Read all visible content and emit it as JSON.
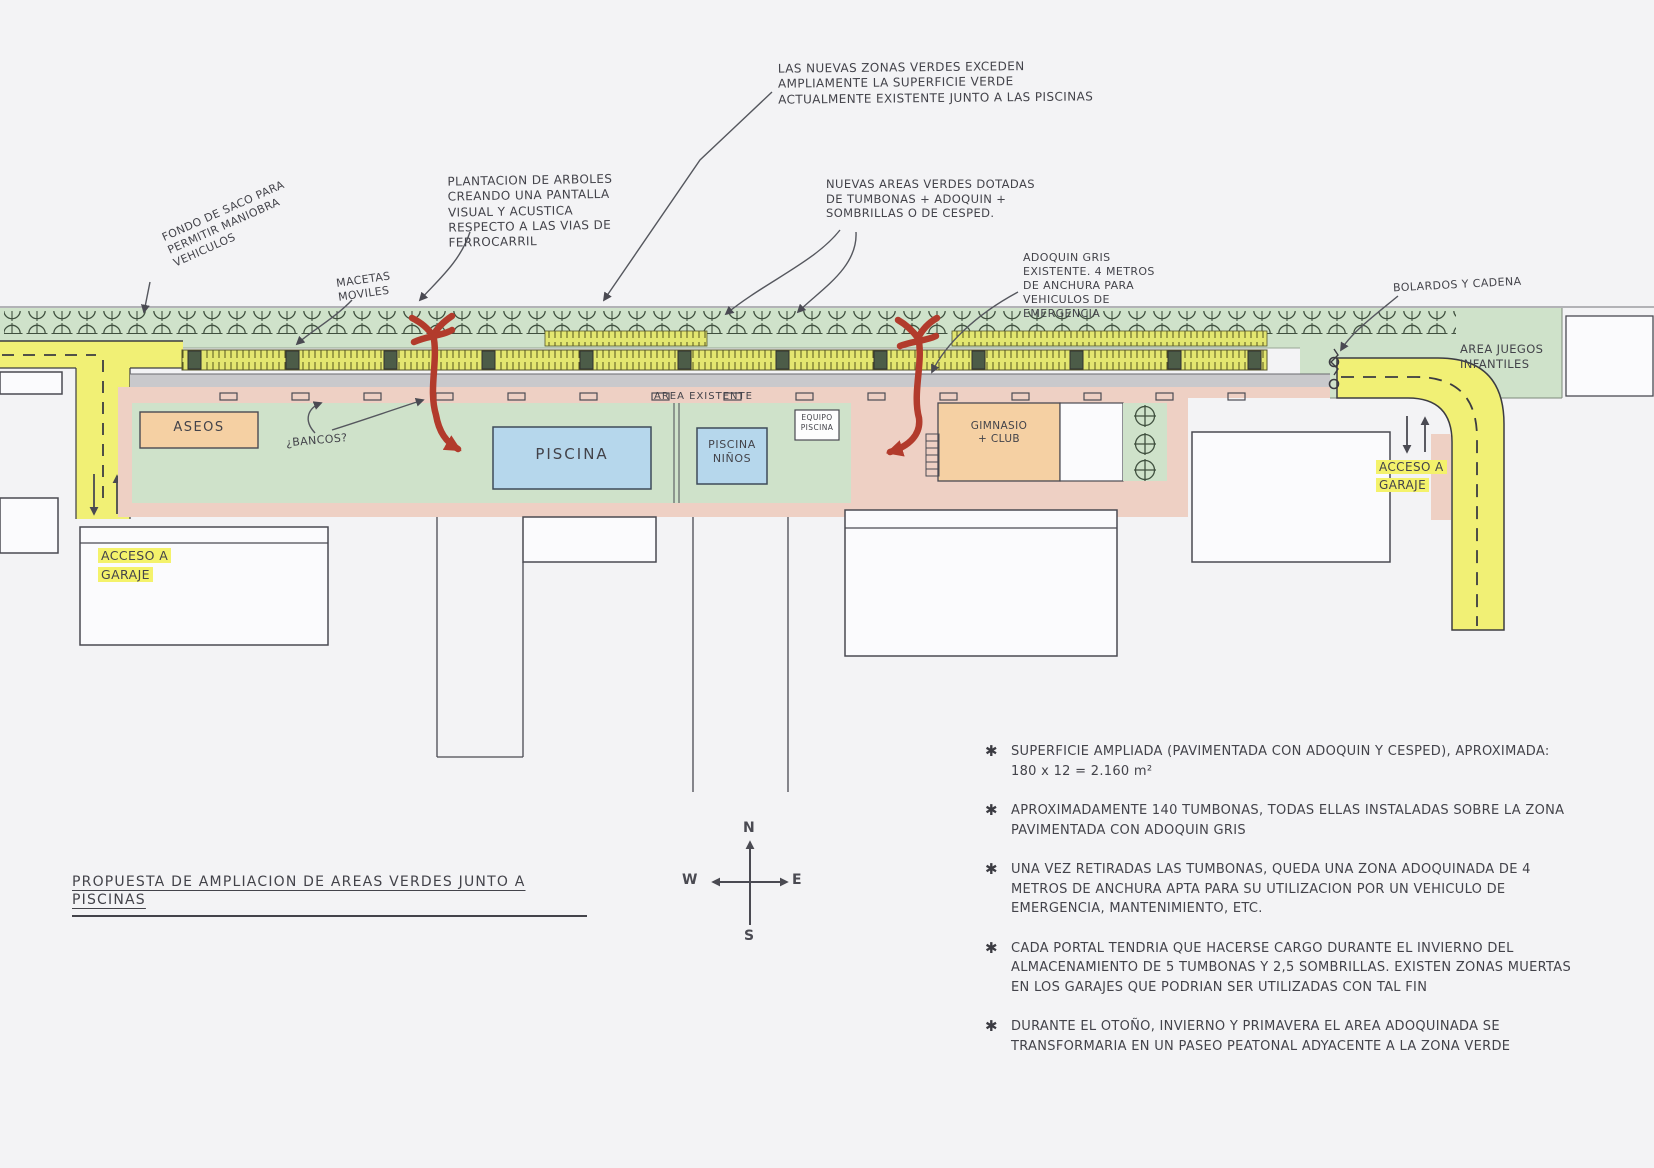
{
  "title": "PROPUESTA DE AMPLIACION DE AREAS VERDES JUNTO A PISCINAS",
  "note_bullet": "✱",
  "annotations": {
    "new_green_zones": "LAS NUEVAS ZONAS VERDES EXCEDEN AMPLIAMENTE LA SUPERFICIE VERDE ACTUALMENTE EXISTENTE JUNTO A LAS PISCINAS",
    "tree_planting": "PLANTACION DE ARBOLES CREANDO UNA PANTALLA VISUAL Y ACUSTICA RESPECTO A LAS VIAS DE FERROCARRIL",
    "new_green_areas": "NUEVAS AREAS VERDES DOTADAS DE TUMBONAS + ADOQUIN + SOMBRILLAS O DE CESPED.",
    "gray_paving": "ADOQUIN GRIS EXISTENTE. 4 METROS DE ANCHURA PARA VEHICULOS DE EMERGENCIA",
    "bollards_chain": "BOLARDOS Y CADENA",
    "cul_de_sac": "FONDO DE SACO PARA PERMITIR MANIOBRA VEHICULOS",
    "movable_planters": "MACETAS MOVILES",
    "benches_question": "¿BANCOS?",
    "existing_area": "AREA EXISTENTE"
  },
  "plan": {
    "aseos": "ASEOS",
    "piscina": "PISCINA",
    "piscina_ninos": "PISCINA NIÑOS",
    "equipo_piscina": "EQUIPO PISCINA",
    "gimnasio_club": "GIMNASIO + CLUB",
    "area_juegos_infantiles": "AREA JUEGOS INFANTILES",
    "acceso_garaje_left": "ACCESO A GARAJE",
    "acceso_garaje_right": "ACCESO A GARAJE"
  },
  "compass": {
    "north": "N",
    "south": "S",
    "east": "E",
    "west": "W"
  },
  "notes": [
    "SUPERFICIE AMPLIADA (PAVIMENTADA CON ADOQUIN Y CESPED), APROXIMADA: 180 x 12 = 2.160 m²",
    "APROXIMADAMENTE 140 TUMBONAS, TODAS ELLAS INSTALADAS SOBRE LA ZONA PAVIMENTADA CON ADOQUIN GRIS",
    "UNA VEZ RETIRADAS LAS TUMBONAS, QUEDA UNA ZONA ADOQUINADA DE 4 METROS DE ANCHURA APTA PARA SU UTILIZACION POR UN VEHICULO DE EMERGENCIA, MANTENIMIENTO, ETC.",
    "CADA PORTAL TENDRIA QUE HACERSE CARGO DURANTE EL INVIERNO DEL ALMACENAMIENTO DE 5 TUMBONAS Y 2,5 SOMBRILLAS. EXISTEN ZONAS MUERTAS EN LOS GARAJES QUE PODRIAN SER UTILIZADAS CON TAL FIN",
    "DURANTE EL OTOÑO, INVIERNO Y PRIMAVERA EL AREA ADOQUINADA SE TRANSFORMARIA EN UN PASEO PEATONAL ADYACENTE A LA ZONA VERDE"
  ],
  "colors": {
    "paper": "#f3f3f5",
    "ink": "#3b3b42",
    "green_area": "#cfe2ca",
    "yellow_road": "#f1f075",
    "pink_paving": "#eed0c4",
    "orange_building": "#f5d0a3",
    "blue_pool": "#b6d7ec",
    "gray_paving": "#c9c9cc",
    "red_marker": "#b23b2c",
    "highlight": "#f4f26b",
    "tumbona_yellow": "#e3e670"
  }
}
